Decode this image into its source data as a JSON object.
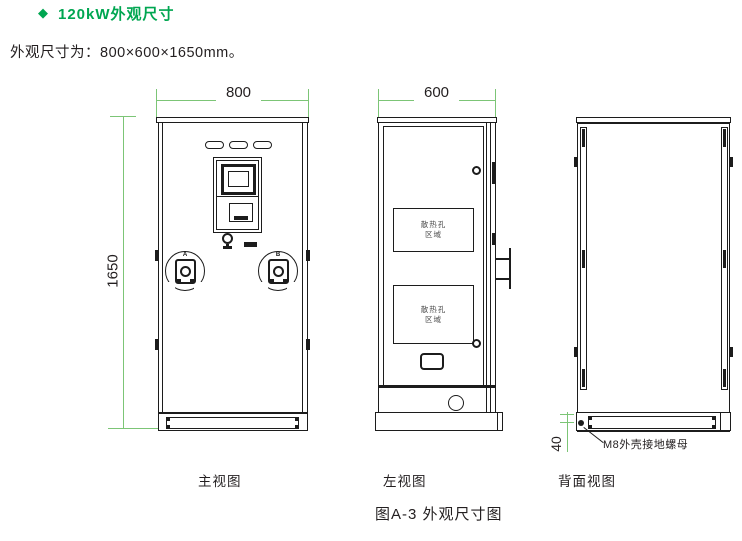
{
  "header": {
    "bullet": "◆",
    "title": "120kW外观尺寸",
    "subtitle": "外观尺寸为：800×600×1650mm。"
  },
  "dimensions": {
    "front_width_mm": "800",
    "front_height_mm": "1650",
    "left_depth_mm": "600",
    "ground_nut_offset_mm": "40"
  },
  "front_view": {
    "caption": "主视图",
    "gun_a_label": "A",
    "gun_b_label": "B"
  },
  "left_view": {
    "caption": "左视图",
    "vent_label_line1": "散热孔",
    "vent_label_line2": "区域"
  },
  "back_view": {
    "caption": "背面视图",
    "ground_nut_note": "M8外壳接地螺母"
  },
  "figure": {
    "caption": "图A-3 外观尺寸图"
  },
  "colors": {
    "accent_green": "#00A651",
    "dimension_green": "#7CC576",
    "line_dark": "#1C1C1C"
  }
}
